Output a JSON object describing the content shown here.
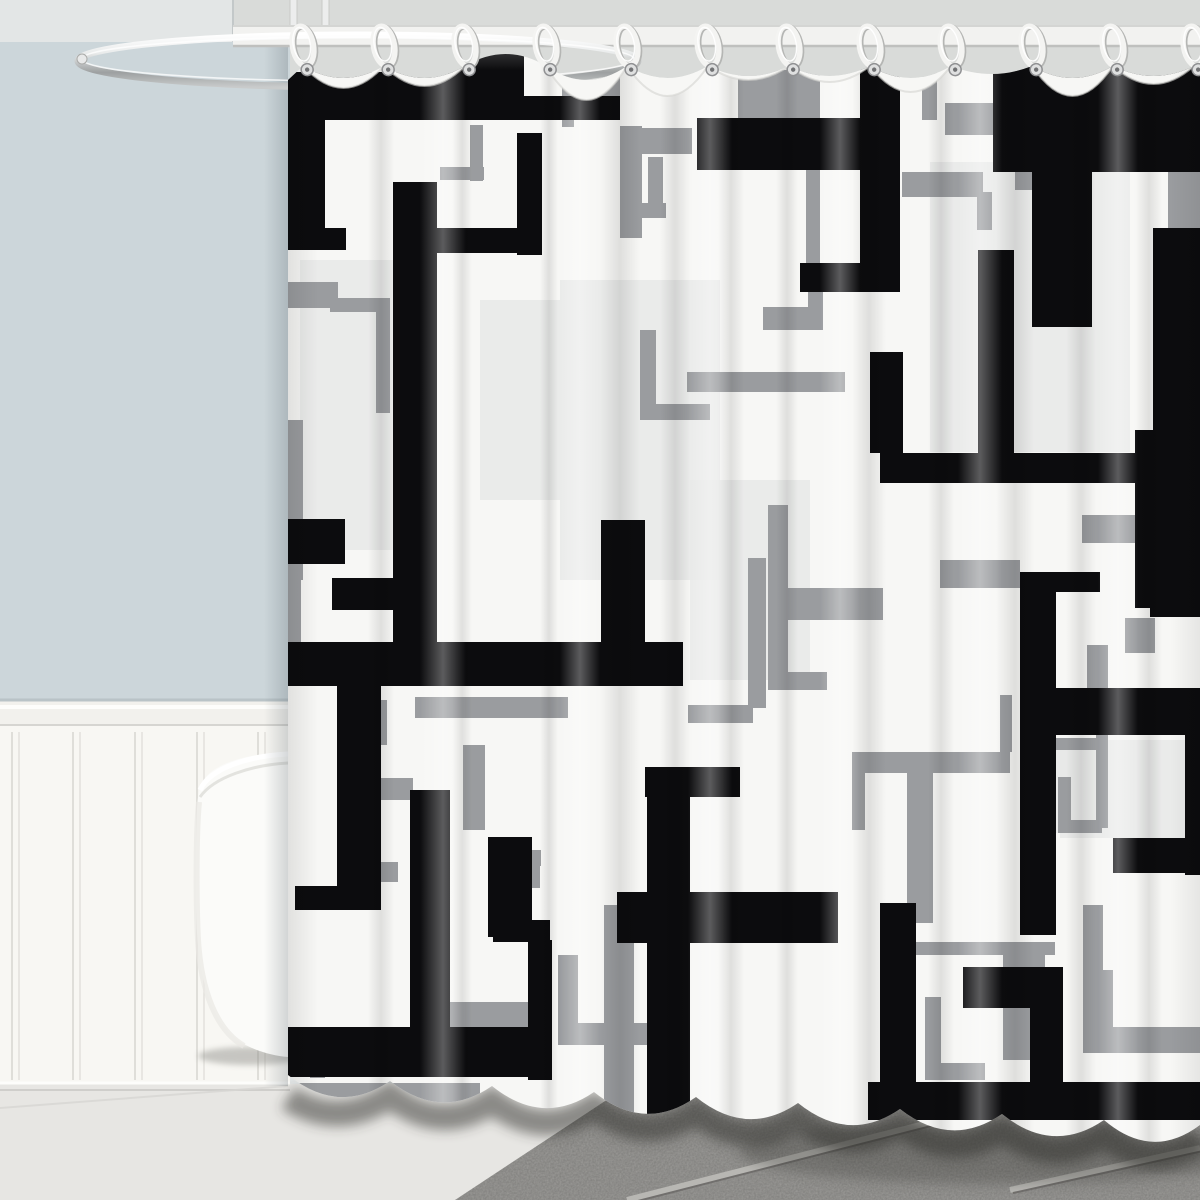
{
  "scene": {
    "width": 1200,
    "height": 1200,
    "description": "Product photo: black, gray and white geometric maze-pattern shower curtain hanging from white rings on an oval chrome rod, in a bathroom with light blue-gray wall, white beadboard wainscoting, white bathtub edge and gray tile floor"
  },
  "colors": {
    "ceiling": "#e3e6e6",
    "wall_blue": "#ccd6da",
    "shower_wall": "#d9dbd9",
    "corner_line": "#c3c8c9",
    "rail": "#f2f1ed",
    "rail_shadow": "#b9c3c7",
    "rail_under": "#d6d5d1",
    "wainscot": "#f8f7f3",
    "plank_line": "#dfded9",
    "floor_left": "#e7e6e3",
    "floor_line": "#d8d7d4",
    "lip_light": "#fdfdfb",
    "lip_shadow": "#cfcecb",
    "tile": "#9d9c99",
    "grout_light": "#b8b7b3",
    "grout_dark": "#716f6d",
    "rod_bar": "#f2f2f0",
    "rod_edge_top": "#d4d5d3",
    "rod_edge_bottom": "#bfc0be",
    "pole": "#eceded",
    "pole_edge": "#c9cac8",
    "chrome_hi": "#ffffff",
    "chrome_mid": "#e9ebeb",
    "chrome_dark": "#9da0a1",
    "chrome_low": "#c9cbcb",
    "tub": "#fbfbf9",
    "tub_rim": "#ffffff",
    "tub_rim_shade": "#dededa",
    "tub_shadow": "#8a8a85",
    "curtain_base": "#f7f7f5",
    "pattern_black": "#0c0c0e",
    "pattern_gray": "#9a9c9f",
    "pattern_light": "#e8e9e8",
    "ring_white": "#f4f4f2",
    "ring_shade": "#b5b6b4",
    "grommet": "#dfe0e0",
    "grommet_edge": "#909193",
    "grommet_hole": "#717274",
    "bottom_shadow": "#2e2e2c",
    "lobe_rim": "#d3d3d1"
  },
  "rod": {
    "bar": {
      "x": 233,
      "y": 26,
      "w": 967,
      "h": 20
    },
    "oval": {
      "cx": 358,
      "cy": 61,
      "rx": 280,
      "ry": 26,
      "stroke_w": 7
    },
    "tip": {
      "cx": 82,
      "cy": 59,
      "r": 5
    },
    "poles_x": [
      290,
      322
    ],
    "pole_w": 7,
    "pole_h": 46
  },
  "rings": {
    "count": 12,
    "xs": [
      303,
      384,
      465,
      546,
      627,
      708,
      789,
      870,
      951,
      1032,
      1113,
      1194
    ],
    "attach_y": 46,
    "grommet_y": 70,
    "rx": 10.5,
    "ry": 20,
    "tilt": -10
  },
  "curtain": {
    "left": 288,
    "right": 1200,
    "top": 30,
    "ring_edge_y": 66,
    "sag": [
      78,
      78,
      54,
      80,
      78,
      76,
      76,
      78,
      74,
      78,
      76
    ],
    "lobe": [
      88,
      86,
      56,
      100,
      96,
      80,
      82,
      92,
      74,
      96,
      84
    ],
    "bottom": {
      "y_left": 1088,
      "slope": 0.055,
      "cusps": [
        288,
        390,
        492,
        594,
        696,
        798,
        900,
        1002,
        1104,
        1200
      ],
      "cusp_rise": 13,
      "belly_drop": 25
    },
    "pattern": {
      "black": [
        [
          288,
          72,
          236,
          48
        ],
        [
          448,
          46,
          76,
          74
        ],
        [
          524,
          96,
          96,
          24
        ],
        [
          288,
          120,
          37,
          130
        ],
        [
          288,
          228,
          58,
          22
        ],
        [
          393,
          182,
          44,
          462
        ],
        [
          437,
          228,
          105,
          25
        ],
        [
          517,
          133,
          25,
          122
        ],
        [
          283,
          642,
          400,
          44
        ],
        [
          601,
          520,
          44,
          124
        ],
        [
          337,
          686,
          44,
          200
        ],
        [
          295,
          886,
          86,
          24
        ],
        [
          993,
          62,
          207,
          110
        ],
        [
          1032,
          172,
          60,
          155
        ],
        [
          978,
          250,
          36,
          205
        ],
        [
          1153,
          228,
          47,
          230
        ],
        [
          1135,
          430,
          65,
          178
        ],
        [
          880,
          453,
          320,
          30
        ],
        [
          870,
          352,
          33,
          101
        ],
        [
          697,
          118,
          203,
          52
        ],
        [
          860,
          60,
          40,
          230
        ],
        [
          800,
          263,
          100,
          29
        ],
        [
          1020,
          572,
          36,
          363
        ],
        [
          1020,
          572,
          80,
          20
        ],
        [
          1020,
          688,
          180,
          47
        ],
        [
          1185,
          735,
          15,
          140
        ],
        [
          1113,
          838,
          87,
          35
        ],
        [
          1150,
          578,
          50,
          39
        ],
        [
          617,
          892,
          221,
          51
        ],
        [
          647,
          767,
          43,
          348
        ],
        [
          645,
          767,
          95,
          30
        ],
        [
          880,
          903,
          36,
          197
        ],
        [
          868,
          1082,
          332,
          38
        ],
        [
          963,
          967,
          95,
          41
        ],
        [
          1030,
          967,
          33,
          141
        ],
        [
          285,
          1027,
          265,
          50
        ],
        [
          410,
          790,
          40,
          243
        ],
        [
          283,
          519,
          62,
          45
        ],
        [
          332,
          578,
          105,
          32
        ],
        [
          488,
          837,
          44,
          100
        ],
        [
          493,
          920,
          57,
          22
        ],
        [
          528,
          940,
          24,
          140
        ]
      ],
      "gray": [
        [
          290,
          124,
          14,
          104
        ],
        [
          288,
          282,
          50,
          26
        ],
        [
          470,
          125,
          13,
          56
        ],
        [
          440,
          167,
          44,
          13
        ],
        [
          562,
          75,
          12,
          52
        ],
        [
          572,
          77,
          48,
          20
        ],
        [
          620,
          126,
          22,
          112
        ],
        [
          620,
          128,
          72,
          26
        ],
        [
          648,
          157,
          15,
          60
        ],
        [
          620,
          203,
          46,
          15
        ],
        [
          738,
          70,
          82,
          48
        ],
        [
          806,
          70,
          14,
          200
        ],
        [
          902,
          172,
          81,
          25
        ],
        [
          977,
          192,
          15,
          38
        ],
        [
          945,
          103,
          55,
          32
        ],
        [
          1015,
          68,
          25,
          122
        ],
        [
          922,
          70,
          15,
          50
        ],
        [
          1062,
          92,
          20,
          150
        ],
        [
          1168,
          138,
          32,
          105
        ],
        [
          330,
          298,
          60,
          14
        ],
        [
          376,
          298,
          14,
          115
        ],
        [
          288,
          420,
          15,
          160
        ],
        [
          286,
          575,
          15,
          100
        ],
        [
          415,
          697,
          153,
          21
        ],
        [
          372,
          700,
          15,
          45
        ],
        [
          355,
          778,
          58,
          22
        ],
        [
          463,
          745,
          22,
          85
        ],
        [
          495,
          850,
          46,
          16
        ],
        [
          524,
          850,
          16,
          38
        ],
        [
          340,
          862,
          58,
          20
        ],
        [
          450,
          1002,
          80,
          26
        ],
        [
          310,
          1033,
          15,
          45
        ],
        [
          288,
          1083,
          192,
          28
        ],
        [
          558,
          955,
          20,
          90
        ],
        [
          558,
          1023,
          100,
          22
        ],
        [
          604,
          905,
          30,
          210
        ],
        [
          687,
          372,
          158,
          20
        ],
        [
          763,
          307,
          60,
          23
        ],
        [
          808,
          292,
          15,
          38
        ],
        [
          768,
          505,
          20,
          185
        ],
        [
          768,
          588,
          115,
          32
        ],
        [
          782,
          672,
          45,
          18
        ],
        [
          688,
          705,
          65,
          18
        ],
        [
          852,
          752,
          158,
          21
        ],
        [
          852,
          752,
          13,
          78
        ],
        [
          907,
          773,
          26,
          150
        ],
        [
          1000,
          695,
          12,
          57
        ],
        [
          1053,
          738,
          55,
          12
        ],
        [
          1096,
          735,
          12,
          93
        ],
        [
          1058,
          777,
          13,
          56
        ],
        [
          1058,
          820,
          44,
          13
        ],
        [
          908,
          942,
          147,
          13
        ],
        [
          1003,
          947,
          42,
          113
        ],
        [
          1083,
          905,
          20,
          103
        ],
        [
          1083,
          970,
          30,
          63
        ],
        [
          1083,
          1027,
          117,
          26
        ],
        [
          925,
          997,
          16,
          83
        ],
        [
          925,
          1063,
          60,
          17
        ],
        [
          940,
          560,
          80,
          28
        ],
        [
          1082,
          515,
          53,
          28
        ],
        [
          1125,
          618,
          30,
          35
        ],
        [
          1087,
          645,
          21,
          90
        ],
        [
          640,
          330,
          16,
          90
        ],
        [
          640,
          404,
          70,
          16
        ],
        [
          748,
          558,
          18,
          150
        ]
      ],
      "light": [
        [
          930,
          162,
          200,
          290
        ],
        [
          560,
          280,
          160,
          300
        ],
        [
          300,
          260,
          110,
          290
        ],
        [
          1060,
          740,
          125,
          98
        ],
        [
          690,
          480,
          120,
          200
        ],
        [
          480,
          300,
          80,
          200
        ],
        [
          1053,
          745,
          47,
          88
        ]
      ]
    },
    "streaks": {
      "dark": [
        [
          368,
          26
        ],
        [
          452,
          20
        ],
        [
          540,
          18
        ],
        [
          600,
          40
        ],
        [
          660,
          30
        ],
        [
          718,
          26
        ],
        [
          776,
          22
        ],
        [
          852,
          34
        ],
        [
          928,
          26
        ],
        [
          996,
          38
        ],
        [
          1066,
          30
        ],
        [
          1136,
          26
        ]
      ],
      "light": [
        [
          420,
          46
        ],
        [
          560,
          40
        ],
        [
          688,
          44
        ],
        [
          820,
          40
        ],
        [
          958,
          44
        ],
        [
          1098,
          40
        ]
      ]
    }
  },
  "wall": {
    "blue": {
      "x": 0,
      "y": 42,
      "w": 290,
      "h": 664
    },
    "rail_y": 700,
    "wainscot_y": 726,
    "floor_y": 1084,
    "corner_x": 233
  },
  "wainscot": {
    "plank_xs": [
      12,
      73,
      135,
      197,
      258
    ],
    "groove_gap": 7
  },
  "tub": {
    "rim_y": 752,
    "left_x": 196,
    "bottom_y": 1057,
    "shadow": {
      "cx": 250,
      "cy": 1056,
      "rx": 52,
      "ry": 9
    }
  },
  "floor": {
    "tile_poly": [
      [
        455,
        1200
      ],
      [
        640,
        1078
      ],
      [
        1200,
        1078
      ],
      [
        1200,
        1200
      ]
    ],
    "grout": [
      [
        627,
        1200,
        1104,
        1078
      ],
      [
        1010,
        1190,
        1200,
        1148
      ]
    ],
    "faint_line": [
      0,
      1108,
      288,
      1086
    ]
  }
}
